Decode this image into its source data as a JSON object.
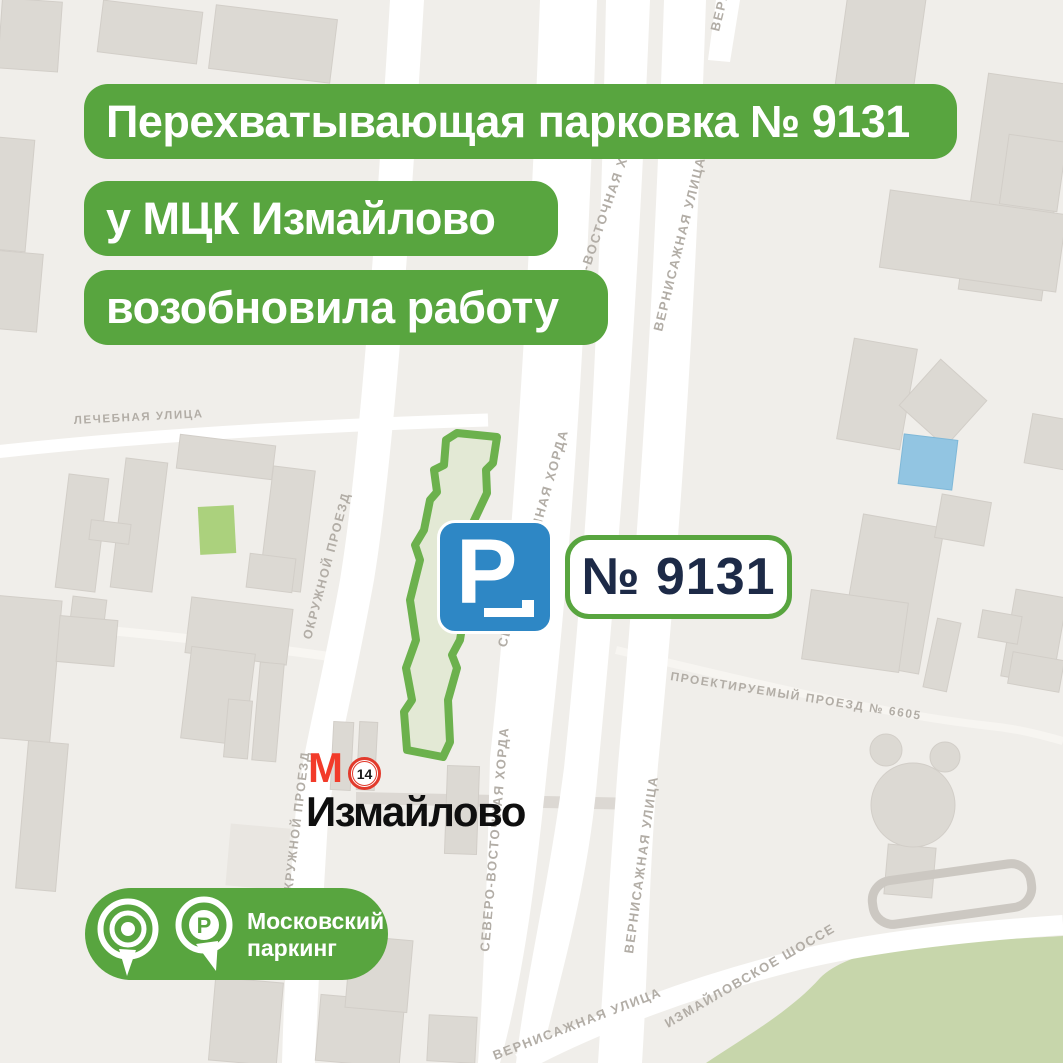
{
  "banners": {
    "line1": "Перехватывающая парковка № 9131",
    "line2": "у МЦК Измайлово",
    "line3": "возобновила работу"
  },
  "parking_zone_sign": {
    "letter": "P"
  },
  "parking_number_badge": {
    "label": "№ 9131"
  },
  "metro": {
    "symbol": "М",
    "line_number": "14",
    "station_name": "Измайлово"
  },
  "brand": {
    "name_line1": "Московский",
    "name_line2": "паркинг",
    "pin_letter": "Р"
  },
  "streets": {
    "lechebnaya_ulitsa": "ЛЕЧЕБНАЯ УЛИЦА",
    "okruzhnoy_proezd": "ОКРУЖНОЙ ПРОЕЗД",
    "severo_vostochnaya_khorda": "СЕВЕРО-ВОСТОЧНАЯ ХОРДА",
    "vernisazhnaya_ulitsa": "ВЕРНИСАЖНАЯ УЛИЦА",
    "proektiruemy_proezd": "ПРОЕКТИРУЕМЫЙ ПРОЕЗД № 6605",
    "izmaylovskoe_shosse": "ИЗМАЙЛОВСКОЕ ШОССЕ"
  },
  "colors": {
    "accent_green": "#58a53f",
    "sign_blue": "#2e87c5",
    "metro_red": "#f23b2a",
    "badge_text": "#1d2a47",
    "map_bg": "#f0eeea",
    "road_white": "#ffffff",
    "building_fill": "#dcd9d3",
    "park_green": "#c7d6ab",
    "small_park_green": "#abd17d",
    "zone_border_green": "#6cb14d",
    "zone_fill": "#e3e9d5",
    "pond_blue": "#92c5e2",
    "label_gray": "#b2ada6"
  }
}
